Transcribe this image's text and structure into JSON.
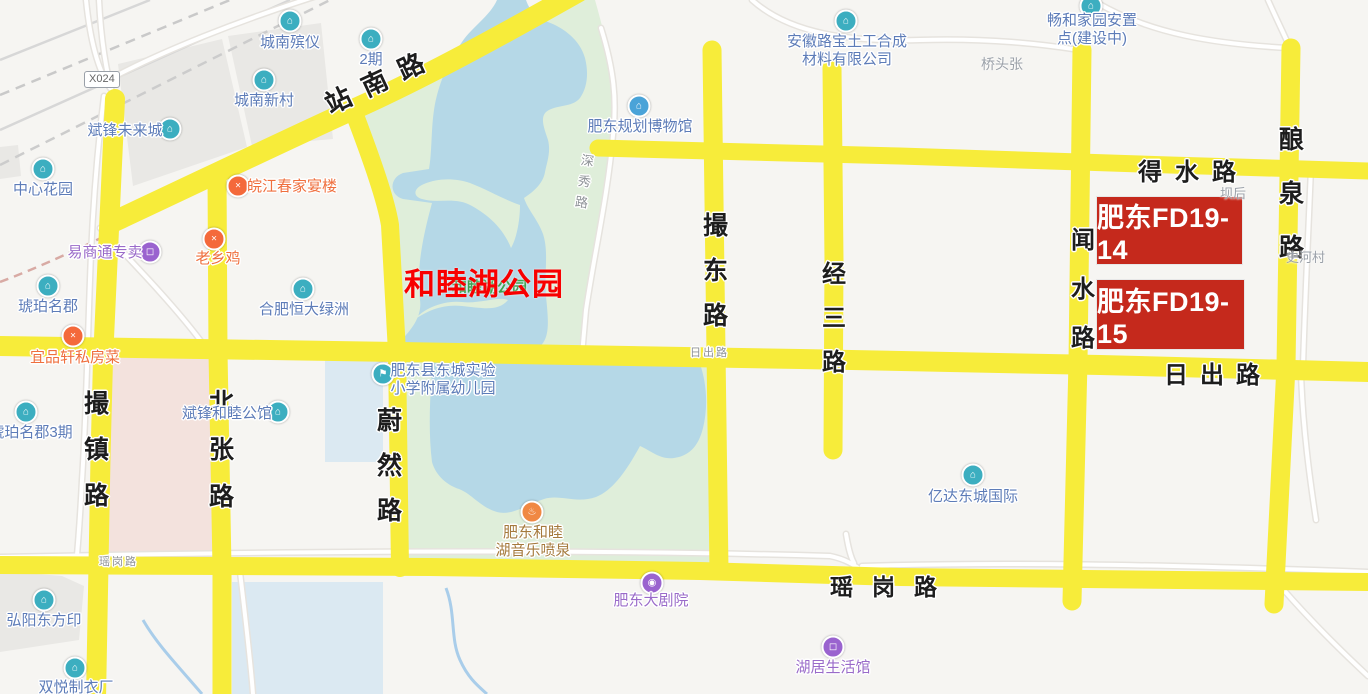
{
  "map_type": "web-map",
  "colors": {
    "background": "#f6f5f2",
    "arterial_road": "#f7ec3a",
    "minor_road": "#ffffff",
    "minor_road_casing": "#e6e3de",
    "park": "#dfeeda",
    "lake": "#b5d8e7",
    "residential_zone": "#f3e2dd",
    "facility_zone_blue": "#dbe9f2",
    "building_gray": "#e9e8e5",
    "railway": "#d7d7d7",
    "parcel_red": "#c5291c",
    "overlay_red_text": "#f80000",
    "poi_blue": "#5d7cb8",
    "poi_purple": "#9a6bc9",
    "poi_orange": "#ef6f3e",
    "poi_brown": "#a57a3d",
    "poi_gray": "#9aa0a8",
    "icon_teal": "#3caec0",
    "icon_purple": "#9a63cf",
    "icon_orange": "#f08843",
    "icon_restaurant": "#f4693b",
    "icon_blue": "#4aa3d8"
  },
  "badge": {
    "text": "X024"
  },
  "annotations": {
    "park_name": {
      "text": "和睦湖公园",
      "x": 404,
      "y": 259
    },
    "park_name_underlay": {
      "text": "和睦湖公园",
      "x": 452,
      "y": 276
    },
    "parcels": [
      {
        "label": "肥东FD19-14",
        "x": 1097,
        "y": 197,
        "w": 145,
        "h": 67
      },
      {
        "label": "肥东FD19-15",
        "x": 1097,
        "y": 280,
        "w": 147,
        "h": 69
      }
    ]
  },
  "road_labels": [
    {
      "text": "站南路",
      "type": "diagonal",
      "x": 326,
      "y": 86,
      "size": 26,
      "spacing": 14,
      "rotate": -25
    },
    {
      "text": "撮镇路",
      "type": "vertical",
      "x": 84,
      "y": 384,
      "size": 25,
      "gap": 10
    },
    {
      "text": "北张路",
      "type": "vertical",
      "x": 209,
      "y": 383,
      "size": 25,
      "gap": 11
    },
    {
      "text": "蔚然路",
      "type": "vertical",
      "x": 377,
      "y": 401,
      "size": 25,
      "gap": 9
    },
    {
      "text": "撮东路",
      "type": "vertical",
      "x": 703,
      "y": 206,
      "size": 25,
      "gap": 9
    },
    {
      "text": "经三路",
      "type": "vertical",
      "x": 822,
      "y": 254,
      "size": 24,
      "gap": 9
    },
    {
      "text": "闻水路",
      "type": "vertical",
      "x": 1071,
      "y": 220,
      "size": 24,
      "gap": 14
    },
    {
      "text": "酿泉路",
      "type": "vertical",
      "x": 1279,
      "y": 120,
      "size": 25,
      "gap": 18
    },
    {
      "text": "得水路",
      "type": "horizontal",
      "x": 1138,
      "y": 152,
      "size": 24,
      "spacing": 13
    },
    {
      "text": "日出路",
      "type": "horizontal",
      "x": 1164,
      "y": 355,
      "size": 24,
      "spacing": 12
    },
    {
      "text": "瑶岗路",
      "type": "horizontal",
      "x": 830,
      "y": 568,
      "size": 23,
      "spacing": 19
    },
    {
      "text": "深秀路",
      "type": "vertical",
      "x": 578,
      "y": 150,
      "size": 13,
      "gap": 2,
      "color": "gray",
      "rotate": 8
    },
    {
      "text": "日出路",
      "type": "horizontal",
      "x": 690,
      "y": 344,
      "size": 11,
      "spacing": 2,
      "color": "gray"
    },
    {
      "text": "瑶岗路",
      "type": "horizontal",
      "x": 99,
      "y": 553,
      "size": 11,
      "spacing": 2,
      "color": "gray"
    }
  ],
  "pois": [
    {
      "lines": [
        "城南殡仪"
      ],
      "cx": 290,
      "top": 34,
      "color": "blue",
      "icon": {
        "kind": "funeral-home",
        "glyph": "community",
        "color": "teal",
        "x": 290,
        "y": 21
      }
    },
    {
      "lines": [
        "2期"
      ],
      "cx": 371,
      "top": 51,
      "color": "blue",
      "icon": {
        "kind": "residential",
        "glyph": "community",
        "color": "teal",
        "x": 371,
        "y": 39
      }
    },
    {
      "lines": [
        "城南新村"
      ],
      "cx": 264,
      "top": 92,
      "color": "blue",
      "icon": {
        "kind": "residential",
        "glyph": "community",
        "color": "teal",
        "x": 264,
        "y": 80
      }
    },
    {
      "lines": [
        "斌锋未来城"
      ],
      "cx": 125,
      "top": 122,
      "color": "blue",
      "icon": {
        "kind": "residential",
        "glyph": "community",
        "color": "teal",
        "x": 170,
        "y": 129
      }
    },
    {
      "lines": [
        "中心花园"
      ],
      "cx": 43,
      "top": 181,
      "color": "blue",
      "icon": {
        "kind": "residential",
        "glyph": "community",
        "color": "teal",
        "x": 43,
        "y": 169
      }
    },
    {
      "lines": [
        "皖江春家宴楼"
      ],
      "cx": 292,
      "top": 178,
      "color": "orange",
      "icon": {
        "kind": "restaurant",
        "glyph": "restaurant",
        "color": "restaurant",
        "x": 238,
        "y": 186
      }
    },
    {
      "lines": [
        "易商通专卖"
      ],
      "cx": 105,
      "top": 244,
      "color": "purple",
      "icon": {
        "kind": "shopping",
        "glyph": "shopping",
        "color": "purple",
        "x": 150,
        "y": 252
      }
    },
    {
      "lines": [
        "老乡鸡"
      ],
      "cx": 218,
      "top": 250,
      "color": "orange",
      "icon": {
        "kind": "restaurant",
        "glyph": "restaurant",
        "color": "restaurant",
        "x": 214,
        "y": 239
      }
    },
    {
      "lines": [
        "琥珀名郡"
      ],
      "cx": 48,
      "top": 298,
      "color": "blue",
      "icon": {
        "kind": "residential",
        "glyph": "community",
        "color": "teal",
        "x": 48,
        "y": 286
      }
    },
    {
      "lines": [
        "合肥恒大绿洲"
      ],
      "cx": 304,
      "top": 301,
      "color": "blue",
      "icon": {
        "kind": "residential",
        "glyph": "community",
        "color": "teal",
        "x": 303,
        "y": 289
      }
    },
    {
      "lines": [
        "宜品轩私房菜"
      ],
      "cx": 75,
      "top": 349,
      "color": "orange",
      "icon": {
        "kind": "restaurant",
        "glyph": "restaurant",
        "color": "restaurant",
        "x": 73,
        "y": 336
      }
    },
    {
      "lines": [
        "琥珀名郡3期"
      ],
      "cx": 31,
      "top": 424,
      "color": "blue",
      "icon": {
        "kind": "residential",
        "glyph": "community",
        "color": "teal",
        "x": 26,
        "y": 412
      }
    },
    {
      "lines": [
        "斌锋和睦公馆"
      ],
      "cx": 227,
      "top": 405,
      "color": "blue",
      "icon": {
        "kind": "residential",
        "glyph": "community",
        "color": "teal",
        "x": 278,
        "y": 412
      }
    },
    {
      "lines": [
        "肥东县东城实验",
        "小学附属幼儿园"
      ],
      "cx": 443,
      "top": 362,
      "color": "blue",
      "icon": {
        "kind": "kindergarten",
        "glyph": "school",
        "color": "teal",
        "x": 383,
        "y": 374
      }
    },
    {
      "lines": [
        "肥东规划博物馆"
      ],
      "cx": 640,
      "top": 118,
      "color": "blue",
      "icon": {
        "kind": "museum",
        "glyph": "museum",
        "color": "blue",
        "x": 639,
        "y": 106
      }
    },
    {
      "lines": [
        "安徽路宝土工合成",
        "材料有限公司"
      ],
      "cx": 847,
      "top": 33,
      "color": "blue",
      "icon": {
        "kind": "company",
        "glyph": "community",
        "color": "teal",
        "x": 846,
        "y": 21
      }
    },
    {
      "lines": [
        "畅和家园安置",
        "点(建设中)"
      ],
      "cx": 1092,
      "top": 12,
      "color": "blue",
      "icon": {
        "kind": "residential",
        "glyph": "community",
        "color": "teal",
        "x": 1091,
        "y": 6
      }
    },
    {
      "lines": [
        "亿达东城国际"
      ],
      "cx": 973,
      "top": 488,
      "color": "blue",
      "icon": {
        "kind": "residential",
        "glyph": "community",
        "color": "teal",
        "x": 973,
        "y": 475
      }
    },
    {
      "lines": [
        "肥东和睦",
        "湖音乐喷泉"
      ],
      "cx": 533,
      "top": 524,
      "color": "brown",
      "icon": {
        "kind": "fountain",
        "glyph": "fountain",
        "color": "orange",
        "x": 532,
        "y": 512
      }
    },
    {
      "lines": [
        "肥东大剧院"
      ],
      "cx": 651,
      "top": 592,
      "color": "purple",
      "icon": {
        "kind": "theater",
        "glyph": "theater",
        "color": "purple",
        "x": 652,
        "y": 583
      }
    },
    {
      "lines": [
        "湖居生活馆"
      ],
      "cx": 833,
      "top": 659,
      "color": "purple",
      "icon": {
        "kind": "shopping",
        "glyph": "shopping",
        "color": "purple",
        "x": 833,
        "y": 647
      }
    },
    {
      "lines": [
        "弘阳东方印"
      ],
      "cx": 44,
      "top": 612,
      "color": "blue",
      "icon": {
        "kind": "residential",
        "glyph": "community",
        "color": "teal",
        "x": 44,
        "y": 600
      }
    },
    {
      "lines": [
        "双悦制衣厂"
      ],
      "cx": 76,
      "top": 679,
      "color": "blue",
      "icon": {
        "kind": "factory",
        "glyph": "community",
        "color": "teal",
        "x": 75,
        "y": 668
      }
    }
  ],
  "area_labels": [
    {
      "text": "桥头张",
      "x": 981,
      "y": 54,
      "size": 14
    },
    {
      "text": "坝后",
      "x": 1220,
      "y": 183,
      "size": 13
    },
    {
      "text": "史河村",
      "x": 1286,
      "y": 247,
      "size": 13
    }
  ]
}
